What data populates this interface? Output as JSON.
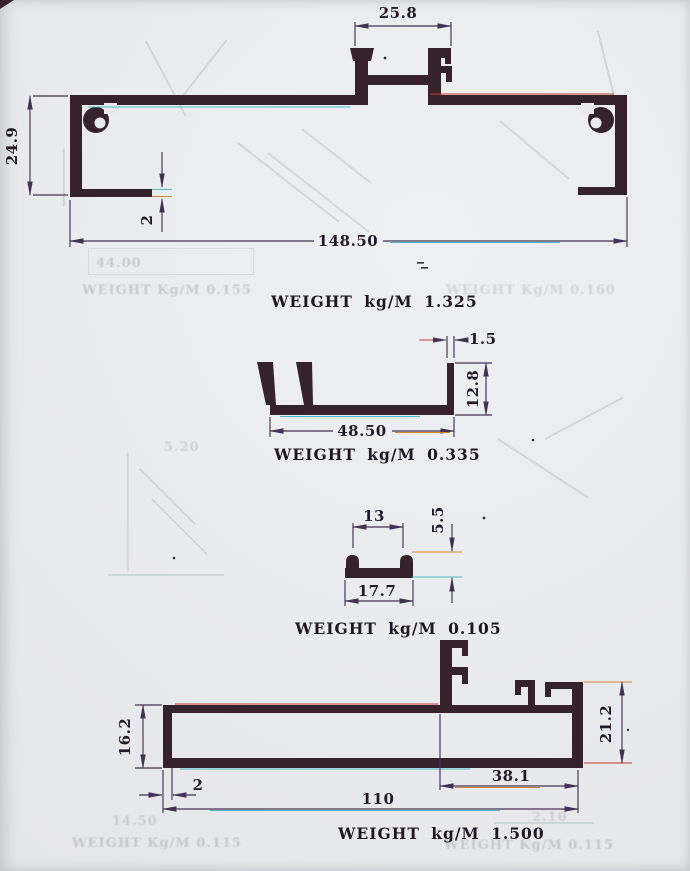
{
  "figures": [
    {
      "id": "profile-1",
      "weight_label": "WEIGHT kg/M 1.325",
      "dims": {
        "top_width": "25.8",
        "left_height": "24.9",
        "flange_thickness": "2",
        "overall_width": "148.50"
      }
    },
    {
      "id": "profile-2",
      "weight_label": "WEIGHT kg/M 0.335",
      "dims": {
        "wall_thickness": "1.5",
        "right_height": "12.8",
        "base_width": "48.50"
      }
    },
    {
      "id": "profile-3",
      "weight_label": "WEIGHT kg/M 0.105",
      "dims": {
        "top_width": "13",
        "height": "5.5",
        "base_width": "17.7"
      }
    },
    {
      "id": "profile-4",
      "weight_label": "WEIGHT kg/M 1.500",
      "dims": {
        "left_height": "16.2",
        "right_height": "21.2",
        "wall_thickness": "2",
        "right_section_width": "38.1",
        "base_width": "110"
      }
    }
  ],
  "ghost_labels": [
    {
      "text": "44.00"
    },
    {
      "text": "WEIGHT Kg/M 0.155"
    },
    {
      "text": "WEIGHT Kg/M 0.160"
    },
    {
      "text": "5.20"
    },
    {
      "text": "14.50"
    },
    {
      "text": "WEIGHT Kg/M 0.115"
    },
    {
      "text": "2.10"
    },
    {
      "text": "WEIGHT Kg/M 0.115"
    }
  ],
  "colors": {
    "paper": "#e9eaee",
    "ink": "#35222c",
    "dim": "#433352"
  }
}
